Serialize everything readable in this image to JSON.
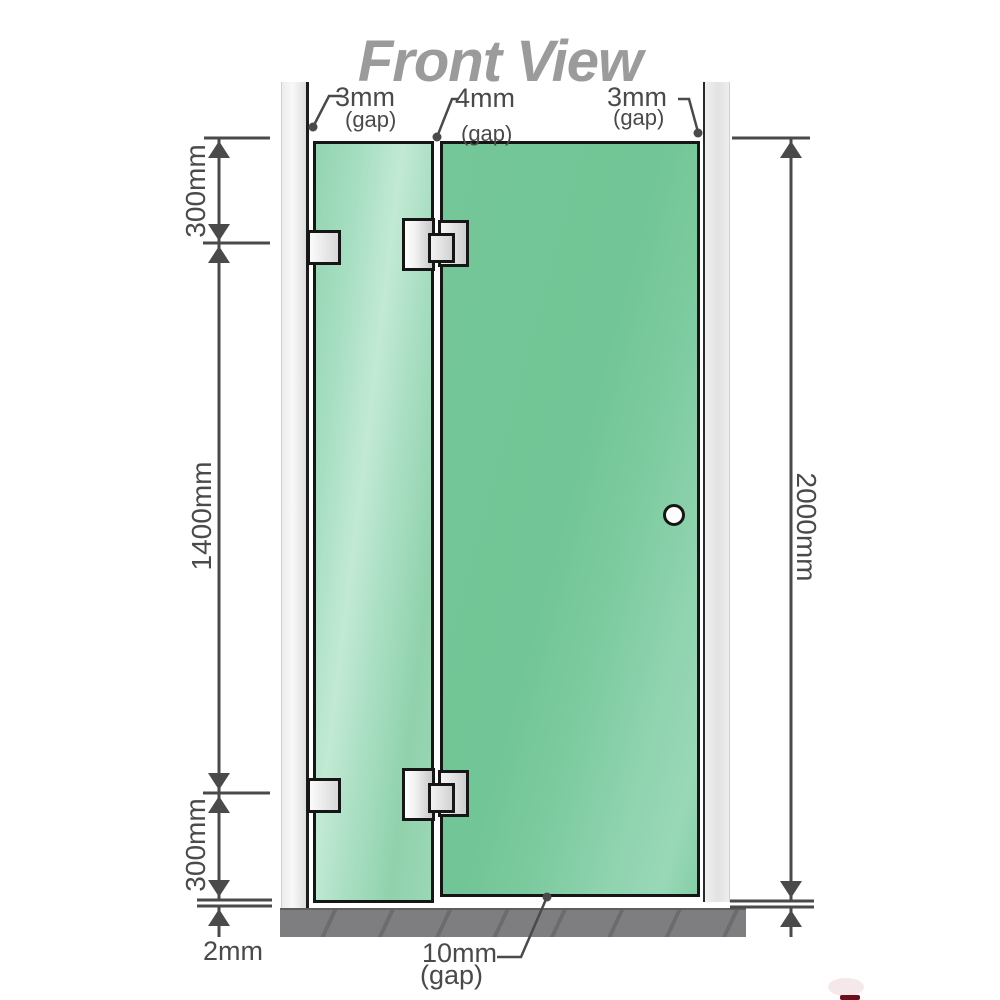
{
  "title": "Front View",
  "top_annotations": {
    "left_gap": {
      "value": "3mm",
      "suffix": "(gap)"
    },
    "middle_gap": {
      "value": "4mm",
      "suffix": "(gap)"
    },
    "right_gap": {
      "value": "3mm",
      "suffix": "(gap)"
    }
  },
  "left_dimension_chain": {
    "top": "300mm",
    "middle": "1400mm",
    "bottom": "300mm",
    "floor_gap": "2mm"
  },
  "right_dimension": {
    "total_height": "2000mm"
  },
  "bottom_annotation": {
    "value": "10mm",
    "suffix": "(gap)"
  },
  "colors": {
    "glass_green": "#7cc99e",
    "glass_highlight": "#c2e9d4",
    "channel_gray": "#ececec",
    "floor_gray": "#7e7e81",
    "dimension_line": "#4a4a4a",
    "title_gray": "#9b9b9b",
    "hardware_border": "#161616",
    "logo_red": "#6b0f1d"
  }
}
